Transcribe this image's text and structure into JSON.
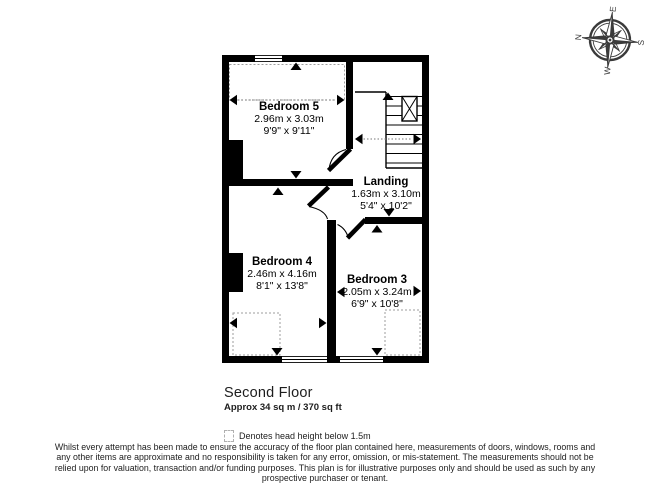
{
  "compass": {
    "n": "N",
    "e": "E",
    "s": "S",
    "w": "W"
  },
  "rooms": {
    "bedroom5": {
      "name": "Bedroom 5",
      "metric": "2.96m x 3.03m",
      "imperial": "9'9\" x 9'11\""
    },
    "landing": {
      "name": "Landing",
      "metric": "1.63m x 3.10m",
      "imperial": "5'4\" x 10'2\""
    },
    "bedroom4": {
      "name": "Bedroom 4",
      "metric": "2.46m x 4.16m",
      "imperial": "8'1\" x 13'8\""
    },
    "bedroom3": {
      "name": "Bedroom 3",
      "metric": "2.05m x 3.24m",
      "imperial": "6'9\" x 10'8\""
    }
  },
  "footer": {
    "floor_title": "Second Floor",
    "area": "Approx 34 sq m / 370 sq ft",
    "legend": "Denotes head height below 1.5m",
    "disclaimer_lines": [
      "Whilst every attempt has been made to ensure the accuracy of the floor plan contained here, measurements of doors, windows, rooms and",
      "any other items are approximate and no responsibility is taken for any error, omission, or mis-statement. The measurements should not be",
      "relied upon for valuation, transaction and/or funding purposes. This plan is for illustrative purposes only and should be used as such by any",
      "prospective purchaser or tenant."
    ]
  },
  "colors": {
    "wall": "#000000",
    "dashed": "#9e9e9e",
    "compass": "#3a3a3a"
  }
}
